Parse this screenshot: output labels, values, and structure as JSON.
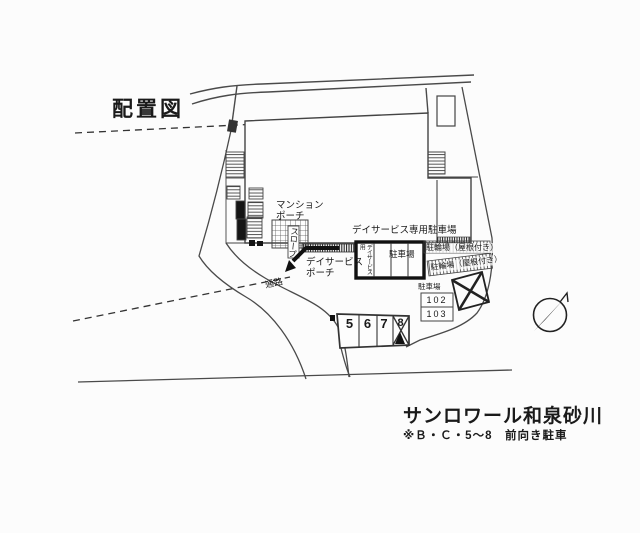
{
  "title": "配置図",
  "plan": {
    "mansion_porch": "マンション\nポーチ",
    "slope": "スロープ",
    "dayservice_porch": "デイサービス\nポーチ",
    "dayservice_parking_title": "デイサービス専用駐車場",
    "dayservice_stall_vertical": "デイサービス用",
    "dayservice_stall_parking": "駐車場",
    "bicycle_parking_roofed_1": "駐輪場（屋根付き）",
    "bicycle_parking_roofed_2": "駐輪場（屋根付き）",
    "parking_lot_label": "駐車場",
    "passage": "通路",
    "stall_numbers": [
      "5",
      "6",
      "7",
      "8"
    ],
    "unit_stalls": [
      "102",
      "103"
    ]
  },
  "footer": {
    "building_name": "サンロワール和泉砂川",
    "note": "※Ｂ・Ｃ・5～8　前向き駐車"
  },
  "icons": {
    "compass": "north-arrow"
  },
  "colors": {
    "line": "#444444",
    "ink": "#151515",
    "background": "#fcfcfc"
  }
}
